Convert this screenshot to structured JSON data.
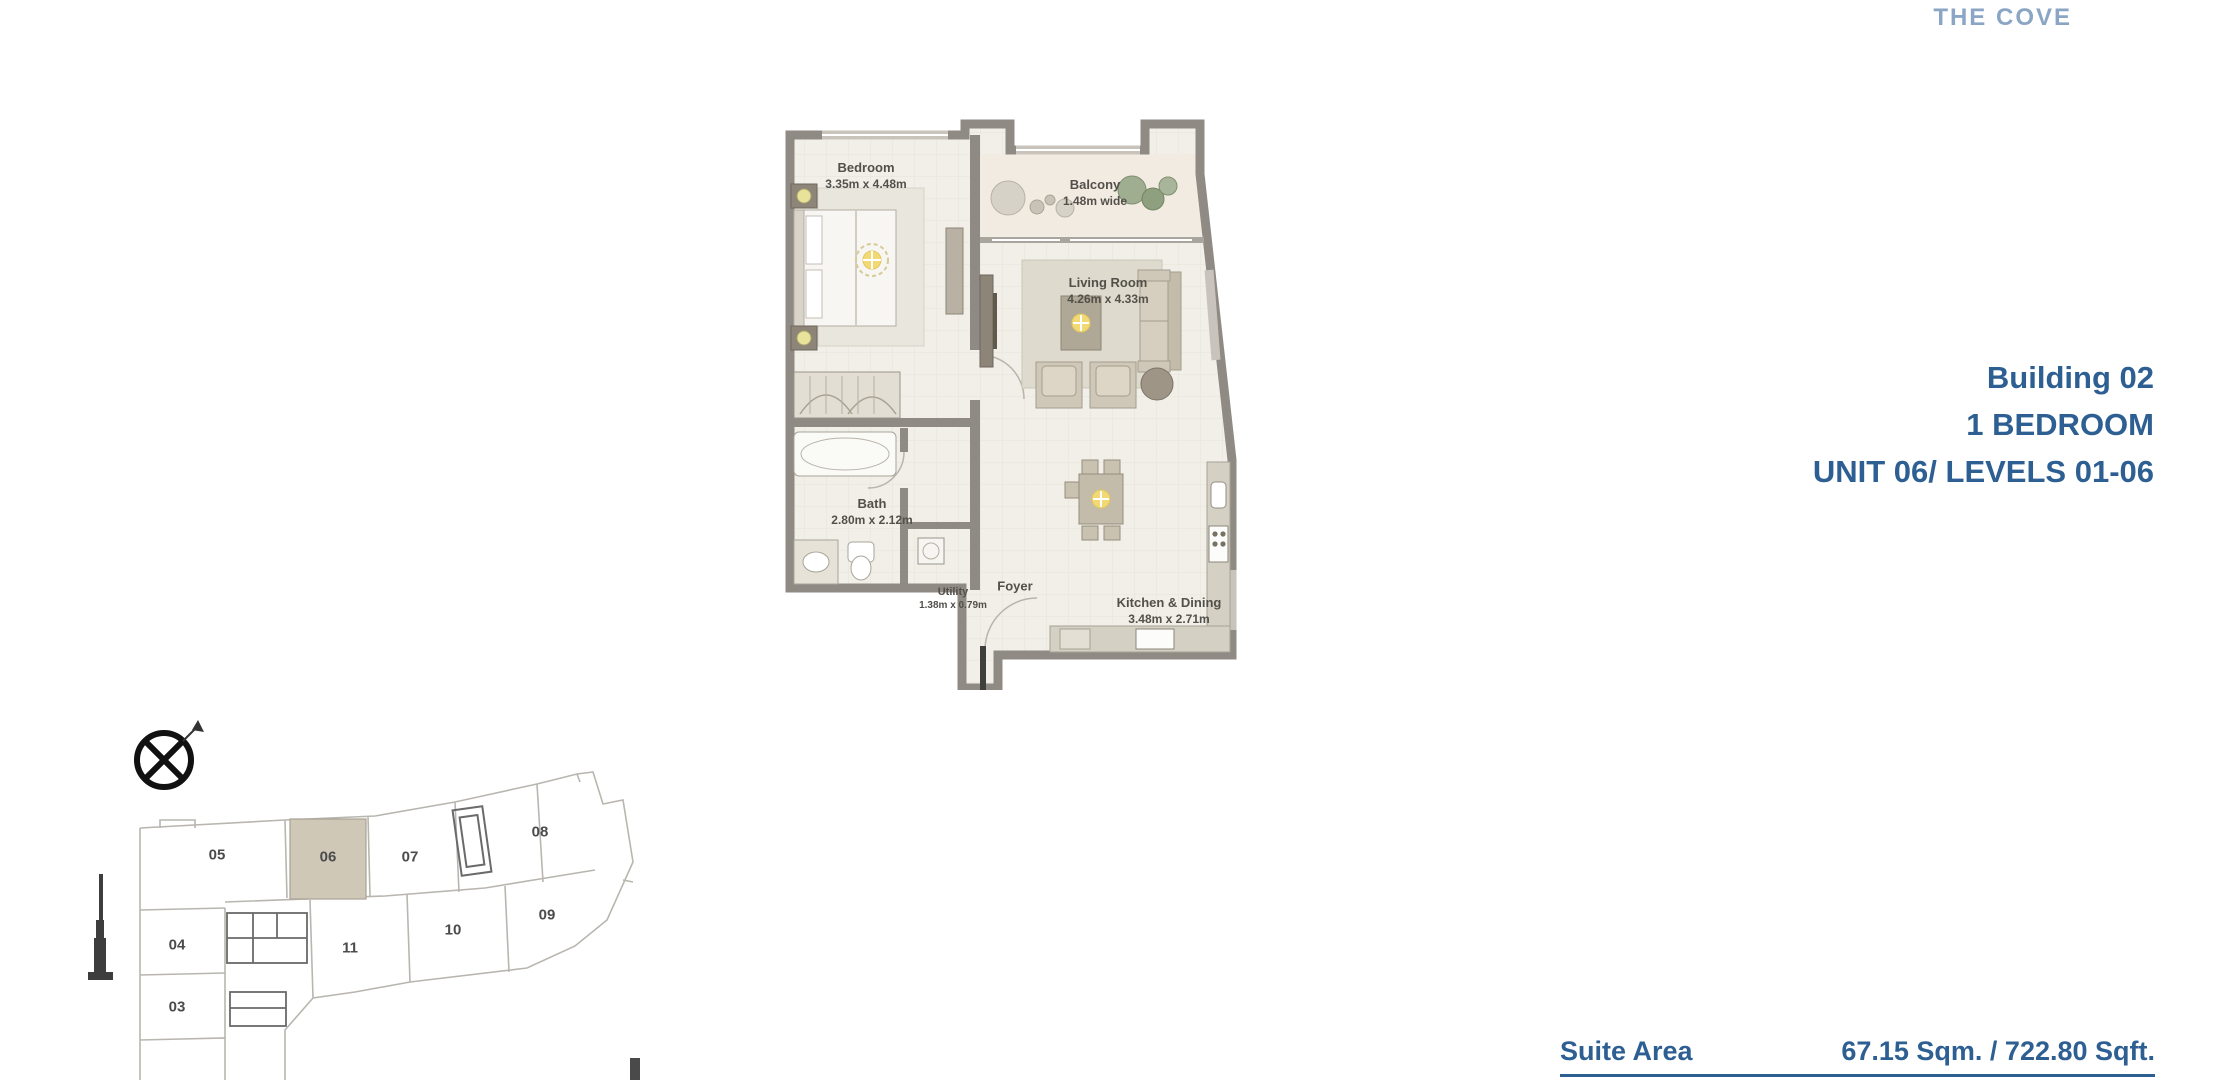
{
  "logo": "THE COVE",
  "info": {
    "building": "Building 02",
    "unit_type": "1 BEDROOM",
    "unit_levels": "UNIT 06/ LEVELS 01-06"
  },
  "suite": {
    "label": "Suite Area",
    "value": "67.15 Sqm. / 722.80 Sqft."
  },
  "floorplan": {
    "rooms": [
      {
        "name": "Bedroom",
        "dims": "3.35m x 4.48m"
      },
      {
        "name": "Balcony",
        "dims": "1.48m wide"
      },
      {
        "name": "Living Room",
        "dims": "4.26m x 4.33m"
      },
      {
        "name": "Bath",
        "dims": "2.80m x 2.12m"
      },
      {
        "name": "Utility",
        "dims": "1.38m x 0.79m"
      },
      {
        "name": "Foyer",
        "dims": ""
      },
      {
        "name": "Kitchen & Dining",
        "dims": "3.48m x 2.71m"
      }
    ]
  },
  "keyplan": {
    "highlighted_unit": "06",
    "units": [
      {
        "label": "05"
      },
      {
        "label": "06"
      },
      {
        "label": "07"
      },
      {
        "label": "08"
      },
      {
        "label": "04"
      },
      {
        "label": "11"
      },
      {
        "label": "10"
      },
      {
        "label": "09"
      },
      {
        "label": "03"
      }
    ]
  },
  "colors": {
    "accent_blue": "#2d5f92",
    "logo_blue": "#8ba6c5",
    "wall_gray": "#8f8a83",
    "floor_cream": "#f1efe8",
    "highlight_tan": "#cfc8b7",
    "light_yellow": "#f3d974"
  }
}
